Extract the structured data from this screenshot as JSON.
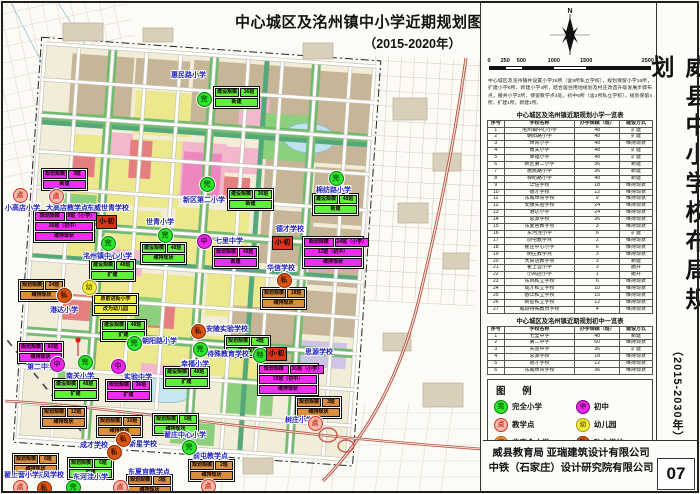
{
  "map_title": {
    "line1": "中心城区及洺州镇中小学近期规划图",
    "line2": "（2015-2020年）"
  },
  "panel": {
    "north_label": "N",
    "scale": {
      "values": [
        0,
        250,
        500,
        1000,
        1500,
        2500
      ],
      "unit": "m",
      "segment_colors": [
        "#111",
        "#fff",
        "#111",
        "#fff",
        "#111"
      ]
    },
    "intro": "中心城区及洺州镇共设置小学26所（含9所私立学校），规划保留小学16所，扩建小学6所，新建小学4所，结合居住用地规划及村庄改造升级发展步骤布点，撤并小学2所，保留教学点4处。初中6所（含2所私立学校），规划保留4所，扩建1所，新建1所。",
    "table_primary": {
      "title": "中心城区及洺州镇近期规划小学一览表",
      "headers": [
        "序号",
        "学校名称",
        "办学规模（班）",
        "建设方式"
      ],
      "rows": [
        [
          "1",
          "洺州镇中心小学",
          "48",
          "扩建"
        ],
        [
          "2",
          "朝阳路小学",
          "48",
          "扩建"
        ],
        [
          "3",
          "世青小学",
          "48",
          "维持现状"
        ],
        [
          "4",
          "南关小学",
          "48",
          "扩建"
        ],
        [
          "5",
          "幸福小学",
          "48",
          "扩建"
        ],
        [
          "6",
          "新区第二小学",
          "36",
          "新建"
        ],
        [
          "7",
          "惠民路小学",
          "36",
          "新建"
        ],
        [
          "8",
          "棉纺路小学",
          "48",
          "新建"
        ],
        [
          "9",
          "华信学校",
          "18",
          "维持现状"
        ],
        [
          "10",
          "德才学校",
          "12",
          "维持现状"
        ],
        [
          "11",
          "东威世青学校",
          "9",
          "维持现状"
        ],
        [
          "12",
          "安陵实验学校",
          "24",
          "维持现状"
        ],
        [
          "13",
          "港达小学",
          "24",
          "维持现状"
        ],
        [
          "14",
          "思源学校",
          "36",
          "维持现状"
        ],
        [
          "15",
          "东夏官教学点",
          "3",
          "维持现状"
        ],
        [
          "16",
          "东河洼小学",
          "6",
          "扩建"
        ],
        [
          "17",
          "前屯教学点",
          "2",
          "维持现状"
        ],
        [
          "18",
          "翟庄中心小学",
          "6",
          "维持现状"
        ],
        [
          "19",
          "树庄教学点",
          "3",
          "维持现状"
        ],
        [
          "20",
          "大高店教学点",
          "3",
          "新建"
        ],
        [
          "21",
          "翟上营小学",
          "3",
          "撤并"
        ],
        [
          "22",
          "小高店小学",
          "1",
          "撤并"
        ],
        [
          "23",
          "东风私立学校",
          "6",
          "维持现状"
        ],
        [
          "24",
          "成才私立学校",
          "10",
          "维持现状"
        ],
        [
          "25",
          "春华私立学校",
          "15",
          "维持现状"
        ],
        [
          "26",
          "新星私立学校",
          "12",
          "维持现状"
        ],
        [
          "27",
          "威县特殊教育学校",
          "4",
          "维持现状"
        ]
      ]
    },
    "table_middle": {
      "title": "中心城区及洺州镇近期规划初中一览表",
      "headers": [
        "序号",
        "学校名称",
        "办学规模（班）",
        "建设方式"
      ],
      "rows": [
        [
          "1",
          "七里中学",
          "48",
          "新建"
        ],
        [
          "2",
          "第二中学",
          "60",
          "维持现状"
        ],
        [
          "3",
          "实验中学",
          "36",
          "扩建"
        ],
        [
          "4",
          "思源学校",
          "18",
          "维持现状"
        ],
        [
          "5",
          "德才学校",
          "12",
          "维持现状"
        ],
        [
          "6",
          "东威世青学校",
          "36",
          "维持现状"
        ]
      ]
    },
    "legend": {
      "title": "图  例",
      "items": [
        {
          "type": "wan",
          "label": "完全小学"
        },
        {
          "type": "zhong",
          "label": "初中"
        },
        {
          "type": "dian",
          "label": "教学点"
        },
        {
          "type": "you",
          "label": "幼儿园"
        },
        {
          "type": "fei",
          "label": "非完全小学"
        },
        {
          "type": "si",
          "label": "私立学校"
        }
      ]
    },
    "vertical_title": {
      "main": "威县中小学校布局规划",
      "sub": "（2015-2030年）"
    },
    "credits": {
      "line1": "威县教育局 亚瑞建筑设计有限公司",
      "line2": "中铁（石家庄）设计研究院有限公司",
      "page": "07"
    }
  },
  "marker_types": {
    "wan": {
      "char": "完",
      "bg": "#2ee62e",
      "ring": "#087a08",
      "text": "#055e05"
    },
    "zhong": {
      "char": "中",
      "bg": "#ec25ec",
      "ring": "#7c067c",
      "text": "#4a014a"
    },
    "dian": {
      "char": "点",
      "bg": "#f6b9ab",
      "ring": "#d32f1f",
      "text": "#c62a18"
    },
    "you": {
      "char": "幼",
      "bg": "#f0ee3a",
      "ring": "#a89310",
      "text": "#7c6a00"
    },
    "fei": {
      "char": "非",
      "bg": "#f59b33",
      "ring": "#b05e08",
      "text": "#7a3e00"
    },
    "si": {
      "char": "私",
      "bg": "#dd5512",
      "ring": "#8a2a00",
      "text": "#401400"
    },
    "te": {
      "char": "特",
      "bg": "#2ee62e",
      "ring": "#087a08",
      "text": "#055e05"
    },
    "xiaochu": {
      "char": "小·初",
      "bg": "#d93516",
      "ring": "#111111",
      "text": "#000000"
    }
  },
  "box_colors": {
    "green": "#5ff13b",
    "magenta": "#f32cf3",
    "orange": "#d98f3f",
    "yellow": "#f0ee3c"
  },
  "map": {
    "markers": [
      {
        "t": "wan",
        "x": 200,
        "y": 95,
        "label": "惠民路小学",
        "lx": 168,
        "ly": 67,
        "box": {
          "c": "green",
          "x": 210,
          "y": 83,
          "rows": [
            [
              "建设规模",
              "36班"
            ],
            [
              "新建"
            ]
          ]
        }
      },
      {
        "t": "wan",
        "x": 203,
        "y": 180,
        "label": "新区第二小学",
        "lx": 180,
        "ly": 192,
        "box": {
          "c": "green",
          "x": 224,
          "y": 185,
          "rows": [
            [
              "建设规模",
              "36班"
            ],
            [
              "新建"
            ]
          ]
        }
      },
      {
        "t": "wan",
        "x": 161,
        "y": 231,
        "label": "世青小学",
        "lx": 143,
        "ly": 214,
        "box": {
          "c": "green",
          "x": 137,
          "y": 239,
          "rows": [
            [
              "建设规模",
              "48班"
            ],
            [
              "维持现状"
            ]
          ]
        }
      },
      {
        "t": "xiaochu",
        "x": 107,
        "y": 218,
        "label": "东威世青学校",
        "lx": 84,
        "ly": 200,
        "box": {
          "c": "magenta",
          "x": 30,
          "y": 207,
          "rows": [
            [
              "规划规模",
              "9班（小学）"
            ],
            [
              "36班（初中）"
            ],
            [
              "维持现状"
            ]
          ]
        }
      },
      {
        "t": "dian",
        "x": 52,
        "y": 192,
        "label": "大高店教学点",
        "lx": 43,
        "ly": 200,
        "box": {
          "c": "magenta",
          "x": 38,
          "y": 165,
          "rows": [
            [
              "规划规模",
              "3班"
            ],
            [
              "新建"
            ]
          ]
        }
      },
      {
        "t": "dian",
        "x": 16,
        "y": 191,
        "label": "小高店小学",
        "lx": 2,
        "ly": 200
      },
      {
        "t": "wan",
        "x": 104,
        "y": 239,
        "label": "洺州镇中心小学",
        "lx": 80,
        "ly": 248,
        "box": {
          "c": "green",
          "x": 86,
          "y": 256,
          "rows": [
            [
              "建设规模",
              "48班"
            ],
            [
              "扩建"
            ]
          ]
        }
      },
      {
        "t": "zhong",
        "x": 200,
        "y": 237,
        "label": "七里中学",
        "lx": 212,
        "ly": 233,
        "box": {
          "c": "magenta",
          "x": 209,
          "y": 243,
          "rows": [
            [
              "规划规模",
              "48班"
            ],
            [
              "新建"
            ]
          ]
        }
      },
      {
        "t": "you",
        "x": 85,
        "y": 283,
        "box": {
          "c": "yellow",
          "x": 89,
          "y": 290,
          "rows": [
            [
              "原前进街小学"
            ],
            [
              "改为幼儿园"
            ]
          ]
        }
      },
      {
        "t": "si",
        "x": 60,
        "y": 291,
        "label": "港达小学",
        "lx": 47,
        "ly": 302,
        "box": {
          "c": "orange",
          "x": 15,
          "y": 276,
          "rows": [
            [
              "规划规模",
              "24班"
            ],
            [
              "维持现状"
            ]
          ]
        }
      },
      {
        "t": "si",
        "x": 280,
        "y": 276,
        "label": "华信学校",
        "lx": 264,
        "ly": 260,
        "box": {
          "c": "orange",
          "x": 257,
          "y": 284,
          "rows": [
            [
              "规划规模",
              "18班"
            ],
            [
              "维持现状"
            ]
          ]
        }
      },
      {
        "t": "xiaochu",
        "x": 283,
        "y": 239,
        "label": "德才学校",
        "lx": 273,
        "ly": 221,
        "box": {
          "c": "magenta",
          "x": 299,
          "y": 233,
          "rows": [
            [
              "规划规模",
              "24班（小学）"
            ],
            [
              "12班（初中）"
            ],
            [
              "维持现状"
            ]
          ]
        }
      },
      {
        "t": "wan",
        "x": 332,
        "y": 174,
        "label": "棉纺路小学",
        "lx": 313,
        "ly": 182,
        "box": {
          "c": "green",
          "x": 309,
          "y": 190,
          "rows": [
            [
              "建设规模",
              "48班"
            ],
            [
              "新建"
            ]
          ]
        }
      },
      {
        "t": "zhong",
        "x": 53,
        "y": 360,
        "label": "第二中学",
        "lx": 24,
        "ly": 359,
        "box": {
          "c": "magenta",
          "x": 14,
          "y": 338,
          "rows": [
            [
              "规划规模",
              "60班"
            ],
            [
              "维持现状"
            ]
          ]
        }
      },
      {
        "t": "wan",
        "x": 81,
        "y": 358,
        "label": "南关小学",
        "lx": 63,
        "ly": 368,
        "box": {
          "c": "green",
          "x": 49,
          "y": 375,
          "rows": [
            [
              "建设规模",
              "48班"
            ],
            [
              "扩建"
            ]
          ]
        }
      },
      {
        "t": "zhong",
        "x": 114,
        "y": 362,
        "label": "实验中学",
        "lx": 121,
        "ly": 369,
        "box": {
          "c": "magenta",
          "x": 102,
          "y": 376,
          "rows": [
            [
              "规划规模",
              "36班"
            ],
            [
              "扩建"
            ]
          ]
        }
      },
      {
        "t": "wan",
        "x": 130,
        "y": 339,
        "label": "朝阳路小学",
        "lx": 139,
        "ly": 333,
        "box": {
          "c": "green",
          "x": 97,
          "y": 316,
          "rows": [
            [
              "建设规模",
              "48班"
            ],
            [
              "扩建"
            ]
          ]
        }
      },
      {
        "t": "si",
        "x": 194,
        "y": 327,
        "label": "安陵实验学校",
        "lx": 203,
        "ly": 321
      },
      {
        "t": "te",
        "x": 256,
        "y": 351,
        "label": "特殊教育学校",
        "lx": 204,
        "ly": 346,
        "box": {
          "c": "green",
          "x": 221,
          "y": 332,
          "rows": [
            [
              "规划规模",
              "4班"
            ],
            [
              "维持现状"
            ]
          ]
        }
      },
      {
        "t": "wan",
        "x": 196,
        "y": 345,
        "label": "幸福小学",
        "lx": 178,
        "ly": 356,
        "box": {
          "c": "green",
          "x": 160,
          "y": 363,
          "rows": [
            [
              "建设规模",
              "48班"
            ],
            [
              "扩建"
            ]
          ]
        }
      },
      {
        "t": "xiaochu",
        "x": 277,
        "y": 350,
        "label": "思源学校",
        "lx": 302,
        "ly": 344,
        "box": {
          "c": "magenta",
          "x": 254,
          "y": 360,
          "rows": [
            [
              "规划规模",
              "36班（小学）"
            ],
            [
              "18班（初中）"
            ],
            [
              "维持现状"
            ]
          ]
        }
      },
      {
        "t": "si",
        "x": 119,
        "y": 435,
        "label": "成才学校",
        "lx": 77,
        "ly": 437,
        "box": {
          "c": "orange",
          "x": 93,
          "y": 412,
          "rows": [
            [
              "规划规模",
              "10班"
            ],
            [
              "维持现状"
            ]
          ]
        }
      },
      {
        "t": "si",
        "x": 110,
        "y": 448,
        "label": "新星学校",
        "lx": 126,
        "ly": 436,
        "box": {
          "c": "orange",
          "x": 37,
          "y": 403,
          "rows": [
            [
              "规划规模",
              "12班"
            ],
            [
              "维持现状"
            ]
          ]
        }
      },
      {
        "t": "wan",
        "x": 69,
        "y": 483,
        "label": "东河洼小学",
        "lx": 70,
        "ly": 469,
        "box": {
          "c": "green",
          "x": 64,
          "y": 454,
          "rows": [
            [
              "规划规模",
              "6班"
            ],
            [
              "扩建"
            ]
          ]
        }
      },
      {
        "t": "si",
        "x": 40,
        "y": 484,
        "label": "东风学校",
        "lx": 33,
        "ly": 467,
        "box": {
          "c": "orange",
          "x": 9,
          "y": 450,
          "rows": [
            [
              "规划规模",
              "6班"
            ],
            [
              "维持现状"
            ]
          ]
        }
      },
      {
        "t": "dian",
        "x": 16,
        "y": 483,
        "label": "翟上营小学",
        "lx": 1,
        "ly": 467
      },
      {
        "t": "dian",
        "x": 116,
        "y": 483,
        "label": "东夏官教学点",
        "lx": 125,
        "ly": 464,
        "box": {
          "c": "orange",
          "x": 123,
          "y": 471,
          "rows": [
            [
              "规划规模",
              "3班"
            ],
            [
              "维持现状"
            ]
          ]
        }
      },
      {
        "t": "wan",
        "x": 185,
        "y": 443,
        "label": "翟庄中心小学",
        "lx": 161,
        "ly": 427,
        "box": {
          "c": "green",
          "x": 149,
          "y": 410,
          "rows": [
            [
              "规划规模",
              "6班"
            ],
            [
              "维持现状"
            ]
          ]
        }
      },
      {
        "t": "dian",
        "x": 204,
        "y": 482,
        "label": "前屯教学点",
        "lx": 190,
        "ly": 448,
        "box": {
          "c": "orange",
          "x": 185,
          "y": 456,
          "rows": [
            [
              "规划规模",
              "2班"
            ],
            [
              "维持现状"
            ]
          ]
        }
      },
      {
        "t": "dian",
        "x": 311,
        "y": 419,
        "label": "树庄小学",
        "lx": 282,
        "ly": 412,
        "box": {
          "c": "orange",
          "x": 292,
          "y": 393,
          "rows": [
            [
              "规划规模",
              "3班"
            ],
            [
              "维持现状"
            ]
          ]
        }
      }
    ]
  }
}
